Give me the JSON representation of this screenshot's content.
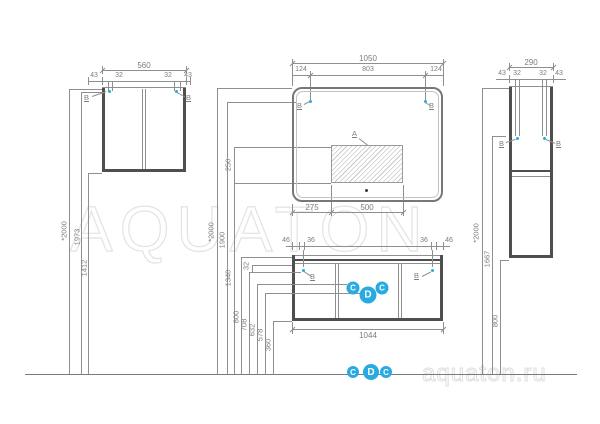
{
  "watermark": {
    "center": "AQUATON",
    "corner": "aquaton.ru"
  },
  "colors": {
    "accent_blue": "#29ABE2",
    "line_gray": "#8f8f8f",
    "panel_dark": "#4f4f4f",
    "watermark_gray": "#e3e3e3"
  },
  "left_cabinet": {
    "width_total": "560",
    "offsets": [
      "43",
      "32",
      "32",
      "43"
    ],
    "mount_labels": [
      "B",
      "B"
    ],
    "heights": {
      "overall": "*2000",
      "mount": "1973",
      "bottom": "1412"
    }
  },
  "mirror": {
    "width_total": "1050",
    "offsets": [
      "124",
      "803",
      "124"
    ],
    "zone_label": "A",
    "mount_labels": [
      "B",
      "B"
    ],
    "bottom_offsets": [
      "275",
      "500"
    ],
    "heights": {
      "overall": "*2000",
      "mount": "1900",
      "zone_height": "250",
      "zone_bottom": "1340"
    }
  },
  "vanity": {
    "offsets": [
      "46",
      "36",
      "36",
      "46"
    ],
    "width_total": "1044",
    "mount_labels": [
      "B",
      "B"
    ],
    "points": [
      "C",
      "D",
      "C"
    ],
    "floor_points": [
      "C",
      "D",
      "C"
    ],
    "heights": {
      "top": "800",
      "mount": "708",
      "gap": "32",
      "point_c": "632",
      "point_d": "578",
      "bottom": "360"
    }
  },
  "tall_cabinet": {
    "width_total": "290",
    "offsets": [
      "43",
      "32",
      "32",
      "43"
    ],
    "mount_labels": [
      "B",
      "B"
    ],
    "heights": {
      "overall": "*2000",
      "mount": "1667",
      "bottom": "800"
    }
  }
}
